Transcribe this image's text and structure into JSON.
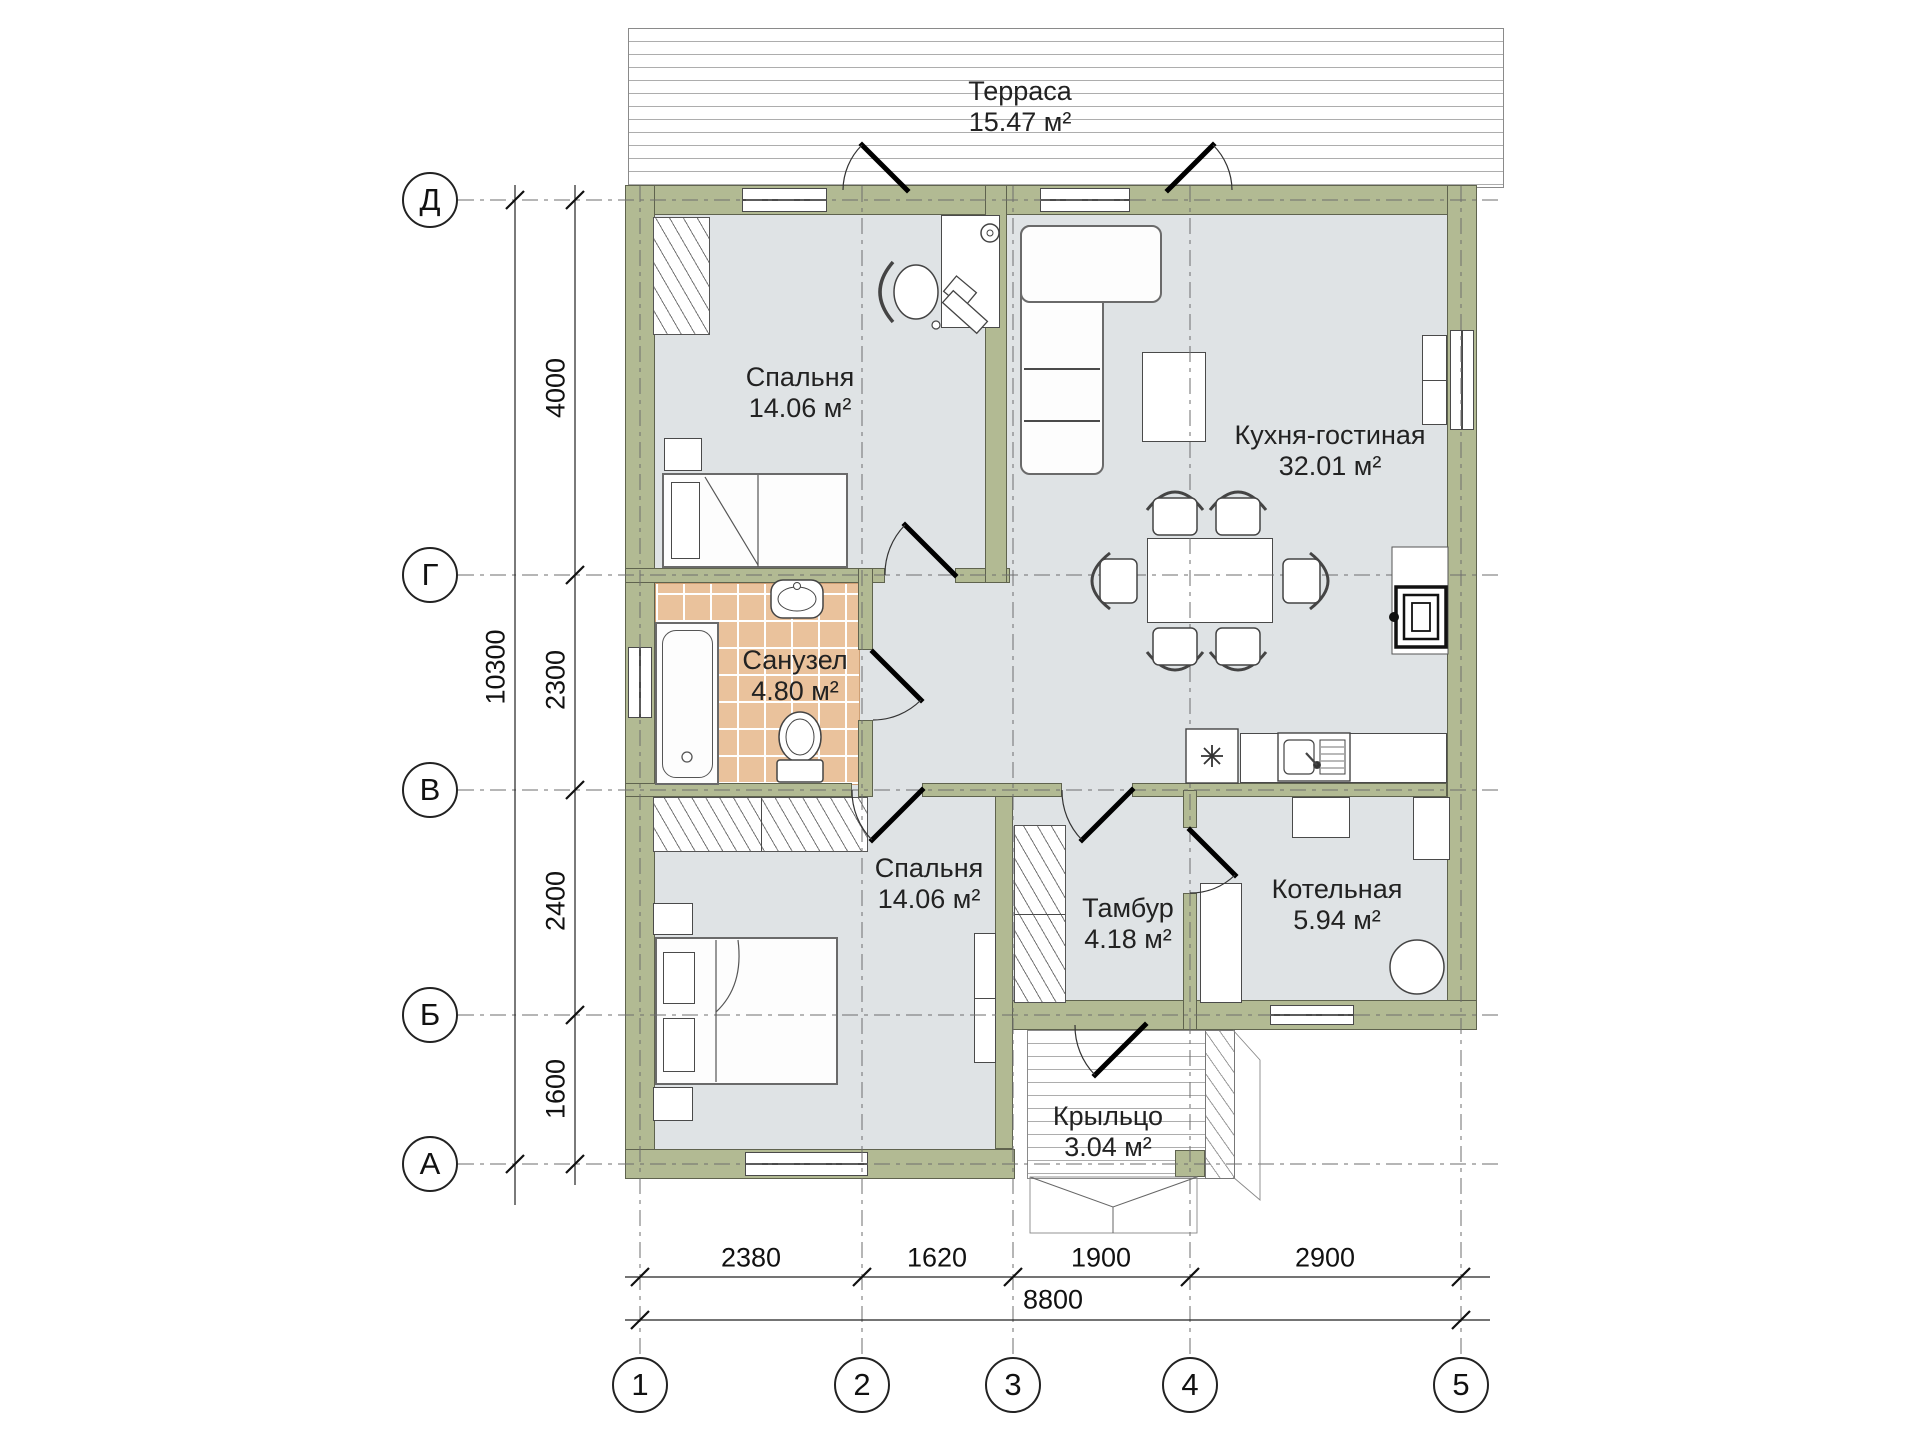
{
  "rooms": {
    "terrace": {
      "name": "Терраса",
      "area": "15.47 м²"
    },
    "bedroom_top": {
      "name": "Спальня",
      "area": "14.06 м²"
    },
    "kitchen_living": {
      "name": "Кухня-гостиная",
      "area": "32.01 м²"
    },
    "bathroom": {
      "name": "Санузел",
      "area": "4.80 м²"
    },
    "bedroom_bottom": {
      "name": "Спальня",
      "area": "14.06 м²"
    },
    "tambour": {
      "name": "Тамбур",
      "area": "4.18 м²"
    },
    "boiler_room": {
      "name": "Котельная",
      "area": "5.94 м²"
    },
    "porch": {
      "name": "Крыльцо",
      "area": "3.04 м²"
    }
  },
  "axes": {
    "rows": [
      "Д",
      "Г",
      "В",
      "Б",
      "А"
    ],
    "cols": [
      "1",
      "2",
      "3",
      "4",
      "5"
    ]
  },
  "dims": {
    "left": [
      "4000",
      "2300",
      "2400",
      "1600"
    ],
    "left_total": "10300",
    "bottom": [
      "2380",
      "1620",
      "1900",
      "2900"
    ],
    "bottom_total": "8800"
  },
  "colors": {
    "wall": "#b2ba93",
    "floor": "#dfe3e5",
    "bath_tile": "#eac29c"
  }
}
